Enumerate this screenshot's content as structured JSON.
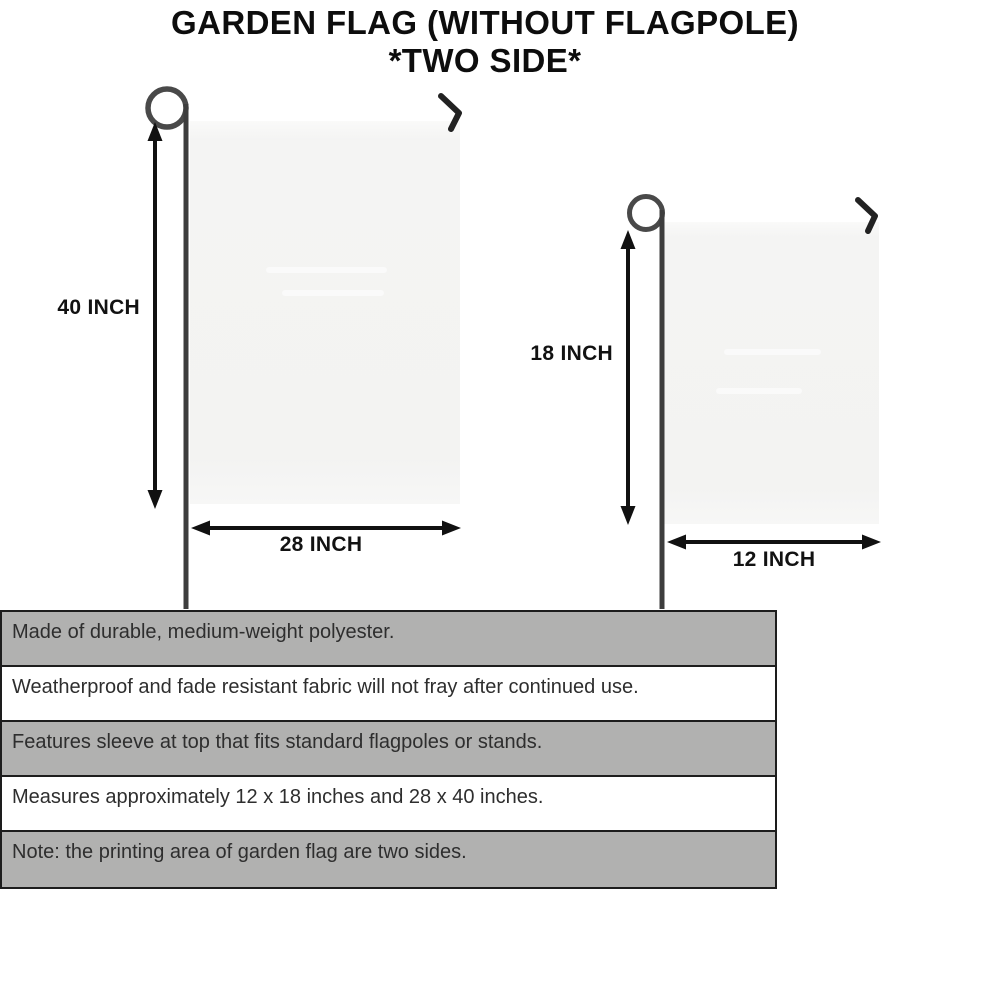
{
  "title": {
    "line1": "GARDEN FLAG (WITHOUT FLAGPOLE)",
    "line2": "*TWO SIDE*"
  },
  "diagram": {
    "large_flag": {
      "height_label": "40 INCH",
      "width_label": "28 INCH"
    },
    "small_flag": {
      "height_label": "18 INCH",
      "width_label": "12 INCH"
    }
  },
  "specs": {
    "rows": [
      {
        "text": "Made of durable, medium-weight polyester.",
        "shaded": true
      },
      {
        "text": "Weatherproof and fade resistant fabric will not fray after continued use.",
        "shaded": false
      },
      {
        "text": "Features sleeve at top that fits standard flagpoles or stands.",
        "shaded": true
      },
      {
        "text": "Measures approximately 12 x 18 inches and 28 x 40 inches.",
        "shaded": false
      },
      {
        "text": "Note: the printing area of garden flag are two sides.",
        "shaded": true
      }
    ]
  },
  "colors": {
    "shaded_row": "#b1b1b0",
    "table_border": "#1d1d1d",
    "flag_fill": "#f3f3f2",
    "arrow": "#111111",
    "pole": "#3d3d3d",
    "title_text": "#0d0d0d"
  }
}
